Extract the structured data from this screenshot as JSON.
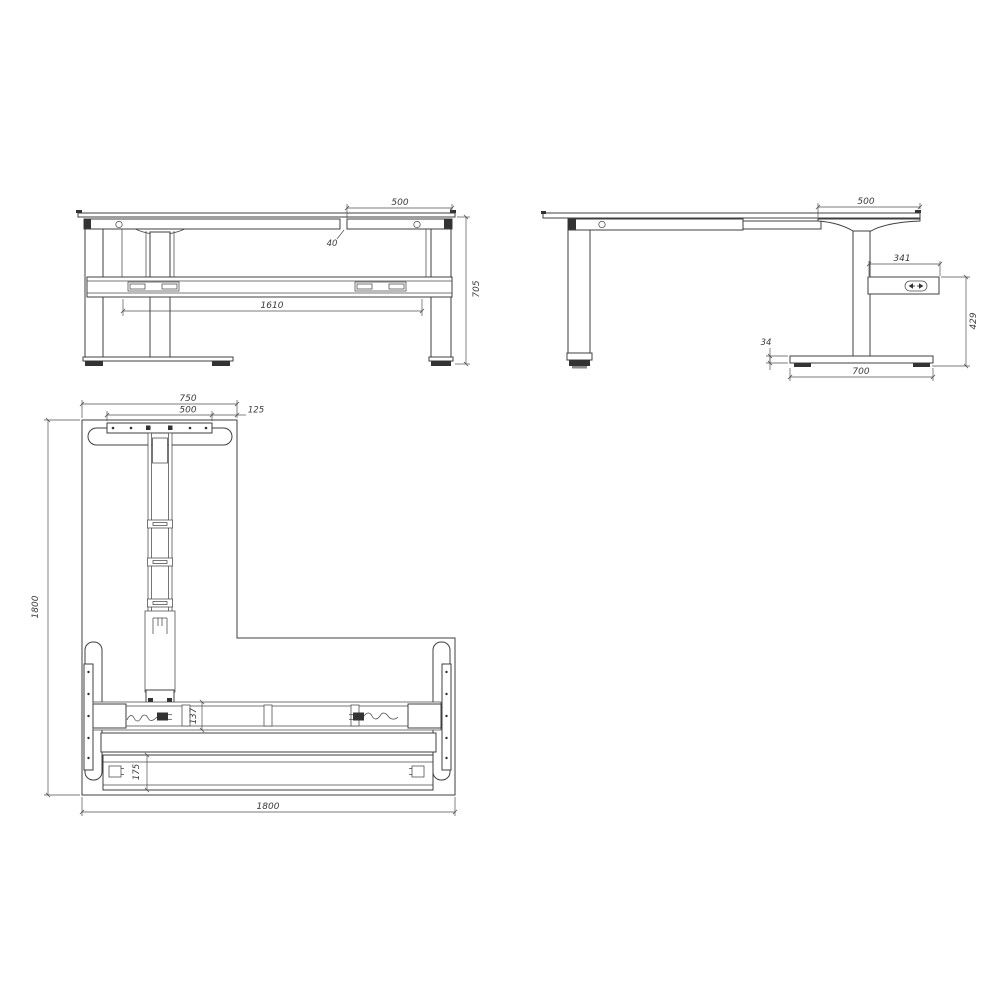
{
  "page": {
    "background": "#ffffff",
    "line_color": "#3f3f3f",
    "dim_color": "#4a4a4a"
  },
  "drawing": {
    "subject": "height-adjustable L-shaped corner desk frame, three-view technical drawing",
    "views": {
      "front": {
        "name": "front-elevation",
        "dims": {
          "overhang": "500",
          "gap": "40",
          "span": "1610",
          "height": "705"
        }
      },
      "side": {
        "name": "side-elevation",
        "dims": {
          "overhang": "500",
          "controller_offset": "341",
          "controller_height": "429",
          "foot_height": "34",
          "foot_length": "700"
        }
      },
      "plan": {
        "name": "plan-view",
        "dims": {
          "return_width": "750",
          "plate_width": "500",
          "edge_offset": "125",
          "depth": "1800",
          "beam_depth": "137",
          "tray_depth": "175",
          "width": "1800"
        }
      }
    }
  }
}
